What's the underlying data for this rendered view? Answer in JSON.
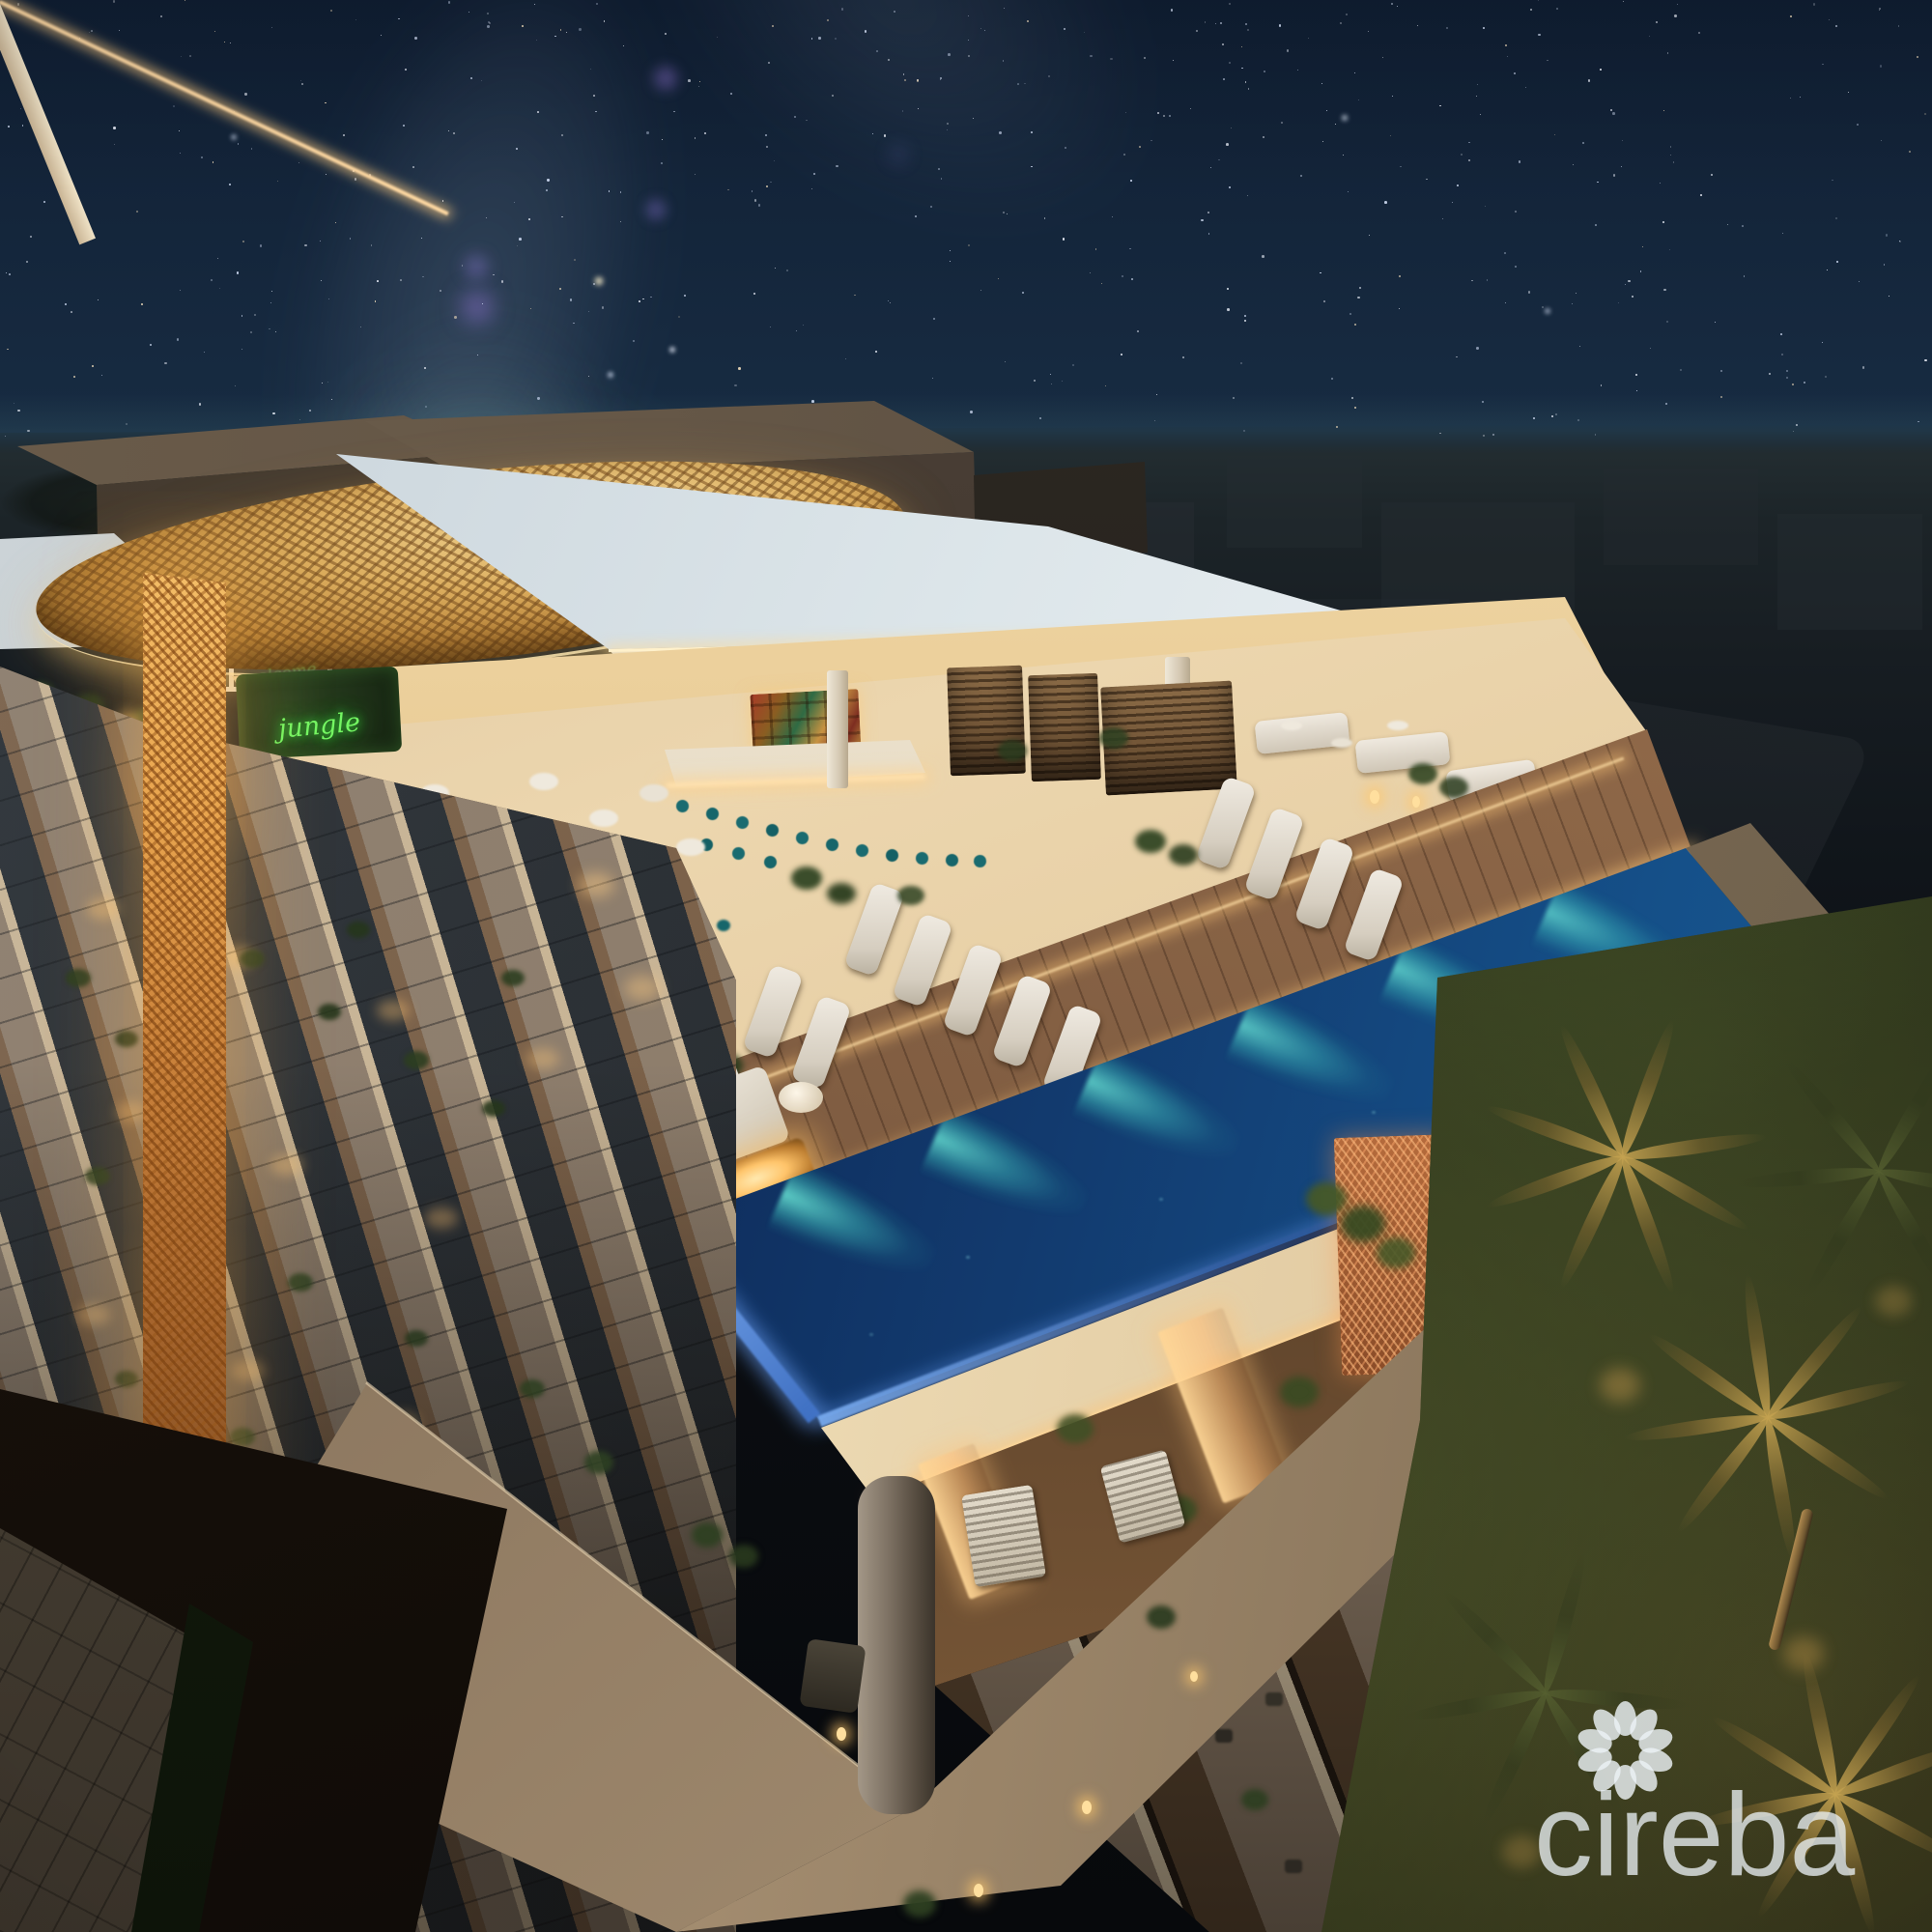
{
  "scene": {
    "title": "Night aerial rendering of a luxury high-rise rooftop with infinity pool, bar and lounge under a starry sky",
    "sky": {
      "type": "starry night",
      "milky_way": true
    },
    "rooftop": {
      "neon_sign": {
        "text": "jungle",
        "color": "#74f763"
      },
      "canopy_reflection_lines": [
        "welcome",
        "to the"
      ],
      "features": [
        "gold mesh canopy",
        "illuminated bar shelves",
        "teal bar stools",
        "slatted cabanas",
        "white loungers on wood deck",
        "fire pit lounge",
        "infinity pool with teal underwater lights"
      ]
    },
    "building": {
      "features": [
        "glass balconies with warm lighting",
        "amber lit lattice wall",
        "copper perforated screens",
        "stone columns",
        "palm landscaping"
      ]
    }
  },
  "watermark": {
    "brand": "cireba",
    "icon": "flower-petal-logo"
  },
  "colors": {
    "sky-top": "#101f33",
    "sky-mid": "#1c3750",
    "sky-horizon": "#2a4a57",
    "pool-deep": "#0c2450",
    "pool-glow": "#46d2c8",
    "pool-glass": "#6fa0e8",
    "gold-canopy": "#dcae5f",
    "lattice-amber": "#e8a44e",
    "warm-light": "#ffd9a2",
    "neon-green": "#74f763",
    "roof-white": "#dde6ea",
    "concrete-dark": "#50443a",
    "wood-deck": "#7c5a40",
    "teal-stool": "#1a6b70",
    "palm-green": "#27301a",
    "watermark-ink": "rgba(232,238,242,0.78)"
  }
}
